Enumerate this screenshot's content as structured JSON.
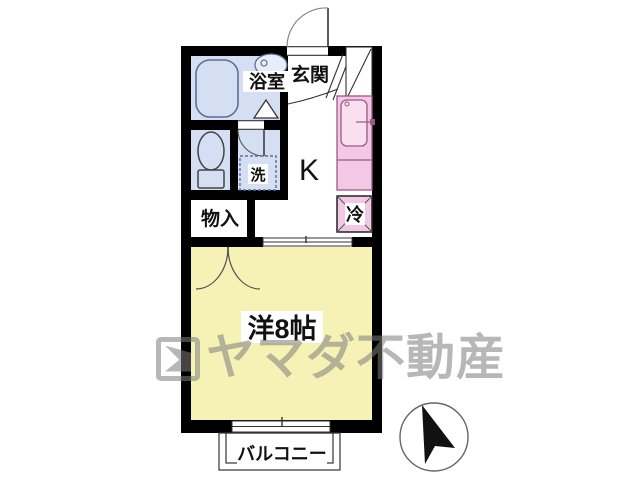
{
  "floorplan": {
    "rooms": {
      "bathroom": {
        "label": "浴室"
      },
      "entrance": {
        "label": "玄関"
      },
      "kitchen": {
        "label": "K"
      },
      "laundry_pan": {
        "label": "洗"
      },
      "storage": {
        "label": "物入"
      },
      "fridge": {
        "label": "冷"
      },
      "main_room": {
        "label": "洋8帖"
      },
      "balcony": {
        "label": "バルコニー"
      }
    },
    "watermark": {
      "text": "ヤマダ不動産"
    },
    "colors": {
      "wet_area": "#d4dff4",
      "kitchen_unit": "#f3c8e6",
      "kitchen_sink": "#f8e0f0",
      "main_room": "#f6f2b5",
      "wall": "#000000",
      "fixture_stroke": "#5d6f95",
      "compass": "#111111"
    }
  }
}
